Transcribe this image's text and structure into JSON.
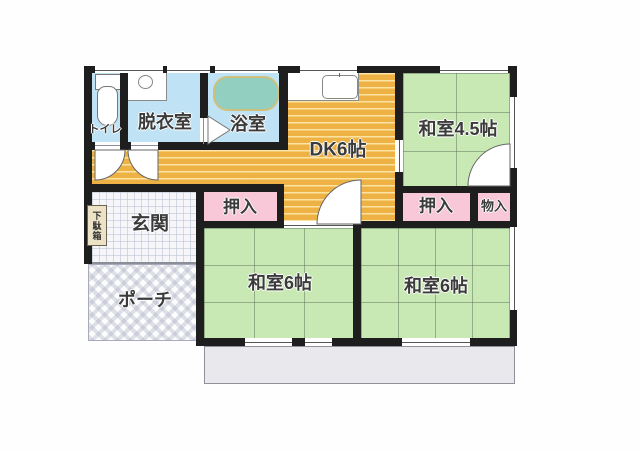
{
  "plan": {
    "rooms": {
      "toilet": {
        "label": "トイレ"
      },
      "dressing": {
        "label": "脱衣室"
      },
      "bath": {
        "label": "浴室"
      },
      "dk": {
        "label": "DK6帖"
      },
      "washitsu45": {
        "label": "和室4.5帖"
      },
      "oshiire_left": {
        "label": "押入"
      },
      "oshiire_right": {
        "label": "押入"
      },
      "monoire": {
        "label": "物入"
      },
      "genkan": {
        "label": "玄関"
      },
      "getabako": {
        "label": "下駄箱"
      },
      "porch": {
        "label": "ポーチ"
      },
      "washitsu6_left": {
        "label": "和室6帖"
      },
      "washitsu6_right": {
        "label": "和室6帖"
      }
    },
    "colors": {
      "wall": "#1e1e1e",
      "water_room": "#bfe2f4",
      "wood_floor": "#eeb244",
      "tatami": "#c9e9b4",
      "closet": "#f8c7d8",
      "tub": "#93cfc0",
      "deck": "#e8e8ed",
      "label_text": "#3b3b3b"
    }
  }
}
